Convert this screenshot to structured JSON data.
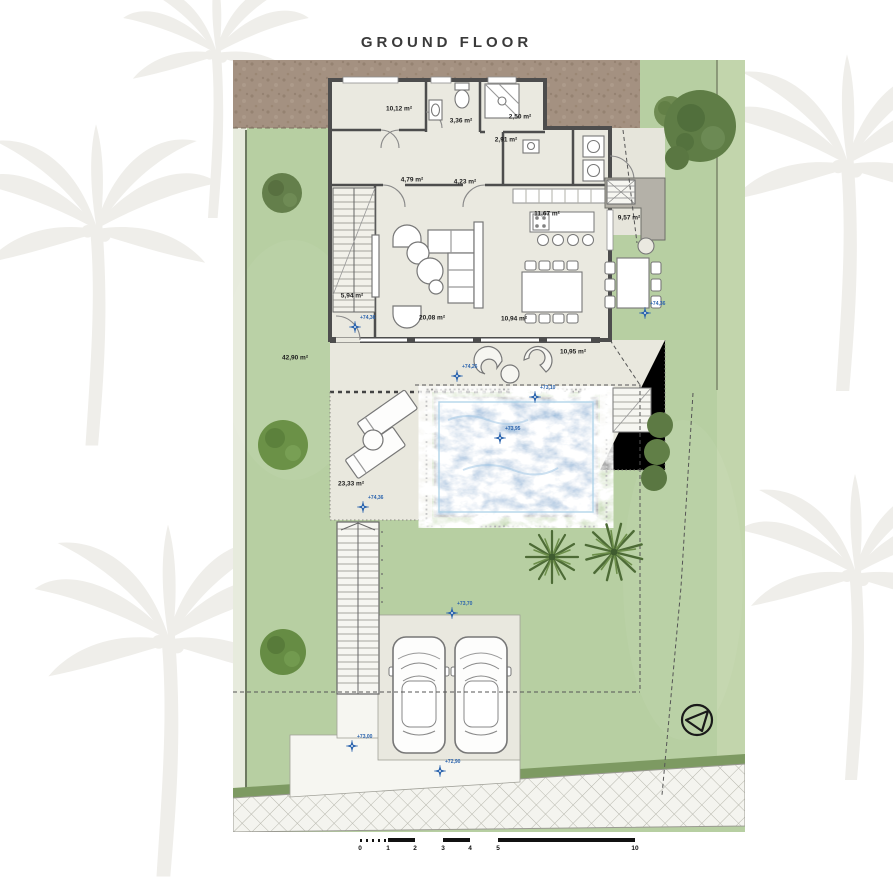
{
  "title": "GROUND FLOOR",
  "colors": {
    "lawn": "#b7cfa2",
    "soil": "#a49181",
    "pool_water": "#66a1cf",
    "wall": "#4d4d4d",
    "interior_floor": "#eae9e0",
    "terrace": "#e9e8de",
    "marker_blue": "#2a63ad"
  },
  "icons": {
    "compass": "north-arrow-icon",
    "marker": "level-point-icon",
    "watermark": "palm-tree-watermark"
  },
  "rooms": [
    {
      "name": "bedroom",
      "area": "10,12 m²",
      "x": 166,
      "y": 49
    },
    {
      "name": "bathroom",
      "area": "3,36 m²",
      "x": 228,
      "y": 61
    },
    {
      "name": "shower-room",
      "area": "2,50 m²",
      "x": 287,
      "y": 57
    },
    {
      "name": "wc",
      "area": "2,91 m²",
      "x": 273,
      "y": 80
    },
    {
      "name": "corridor",
      "area": "4,79 m²",
      "x": 179,
      "y": 120
    },
    {
      "name": "hallway",
      "area": "4,23 m²",
      "x": 232,
      "y": 122
    },
    {
      "name": "kitchen",
      "area": "11,67 m²",
      "x": 314,
      "y": 154
    },
    {
      "name": "entrance-porch",
      "area": "9,57 m²",
      "x": 396,
      "y": 158
    },
    {
      "name": "stairs",
      "area": "5,94 m²",
      "x": 119,
      "y": 236
    },
    {
      "name": "living-room",
      "area": "20,08 m²",
      "x": 199,
      "y": 258
    },
    {
      "name": "dining-room",
      "area": "10,94 m²",
      "x": 281,
      "y": 259
    },
    {
      "name": "terrace",
      "area": "10,95 m²",
      "x": 340,
      "y": 292
    },
    {
      "name": "garden",
      "area": "42,90 m²",
      "x": 62,
      "y": 298
    },
    {
      "name": "pool-terrace",
      "area": "23,33 m²",
      "x": 118,
      "y": 424
    }
  ],
  "level_markers": [
    {
      "value": "+74,36",
      "x": 122,
      "y": 266
    },
    {
      "value": "+74,26",
      "x": 224,
      "y": 315
    },
    {
      "value": "+73,10",
      "x": 302,
      "y": 336
    },
    {
      "value": "+73,95",
      "x": 267,
      "y": 377
    },
    {
      "value": "+74,36",
      "x": 412,
      "y": 252
    },
    {
      "value": "+74,36",
      "x": 130,
      "y": 446
    },
    {
      "value": "+73,70",
      "x": 219,
      "y": 552
    },
    {
      "value": "+73,00",
      "x": 119,
      "y": 685
    },
    {
      "value": "+72,90",
      "x": 207,
      "y": 710
    }
  ],
  "scale_bar": {
    "unit": "m",
    "ticks": [
      {
        "label": "0",
        "x": 0
      },
      {
        "label": "1",
        "x": 28
      },
      {
        "label": "2",
        "x": 55
      },
      {
        "label": "3",
        "x": 83
      },
      {
        "label": "4",
        "x": 110
      },
      {
        "label": "5",
        "x": 138
      },
      {
        "label": "10",
        "x": 275
      }
    ]
  }
}
